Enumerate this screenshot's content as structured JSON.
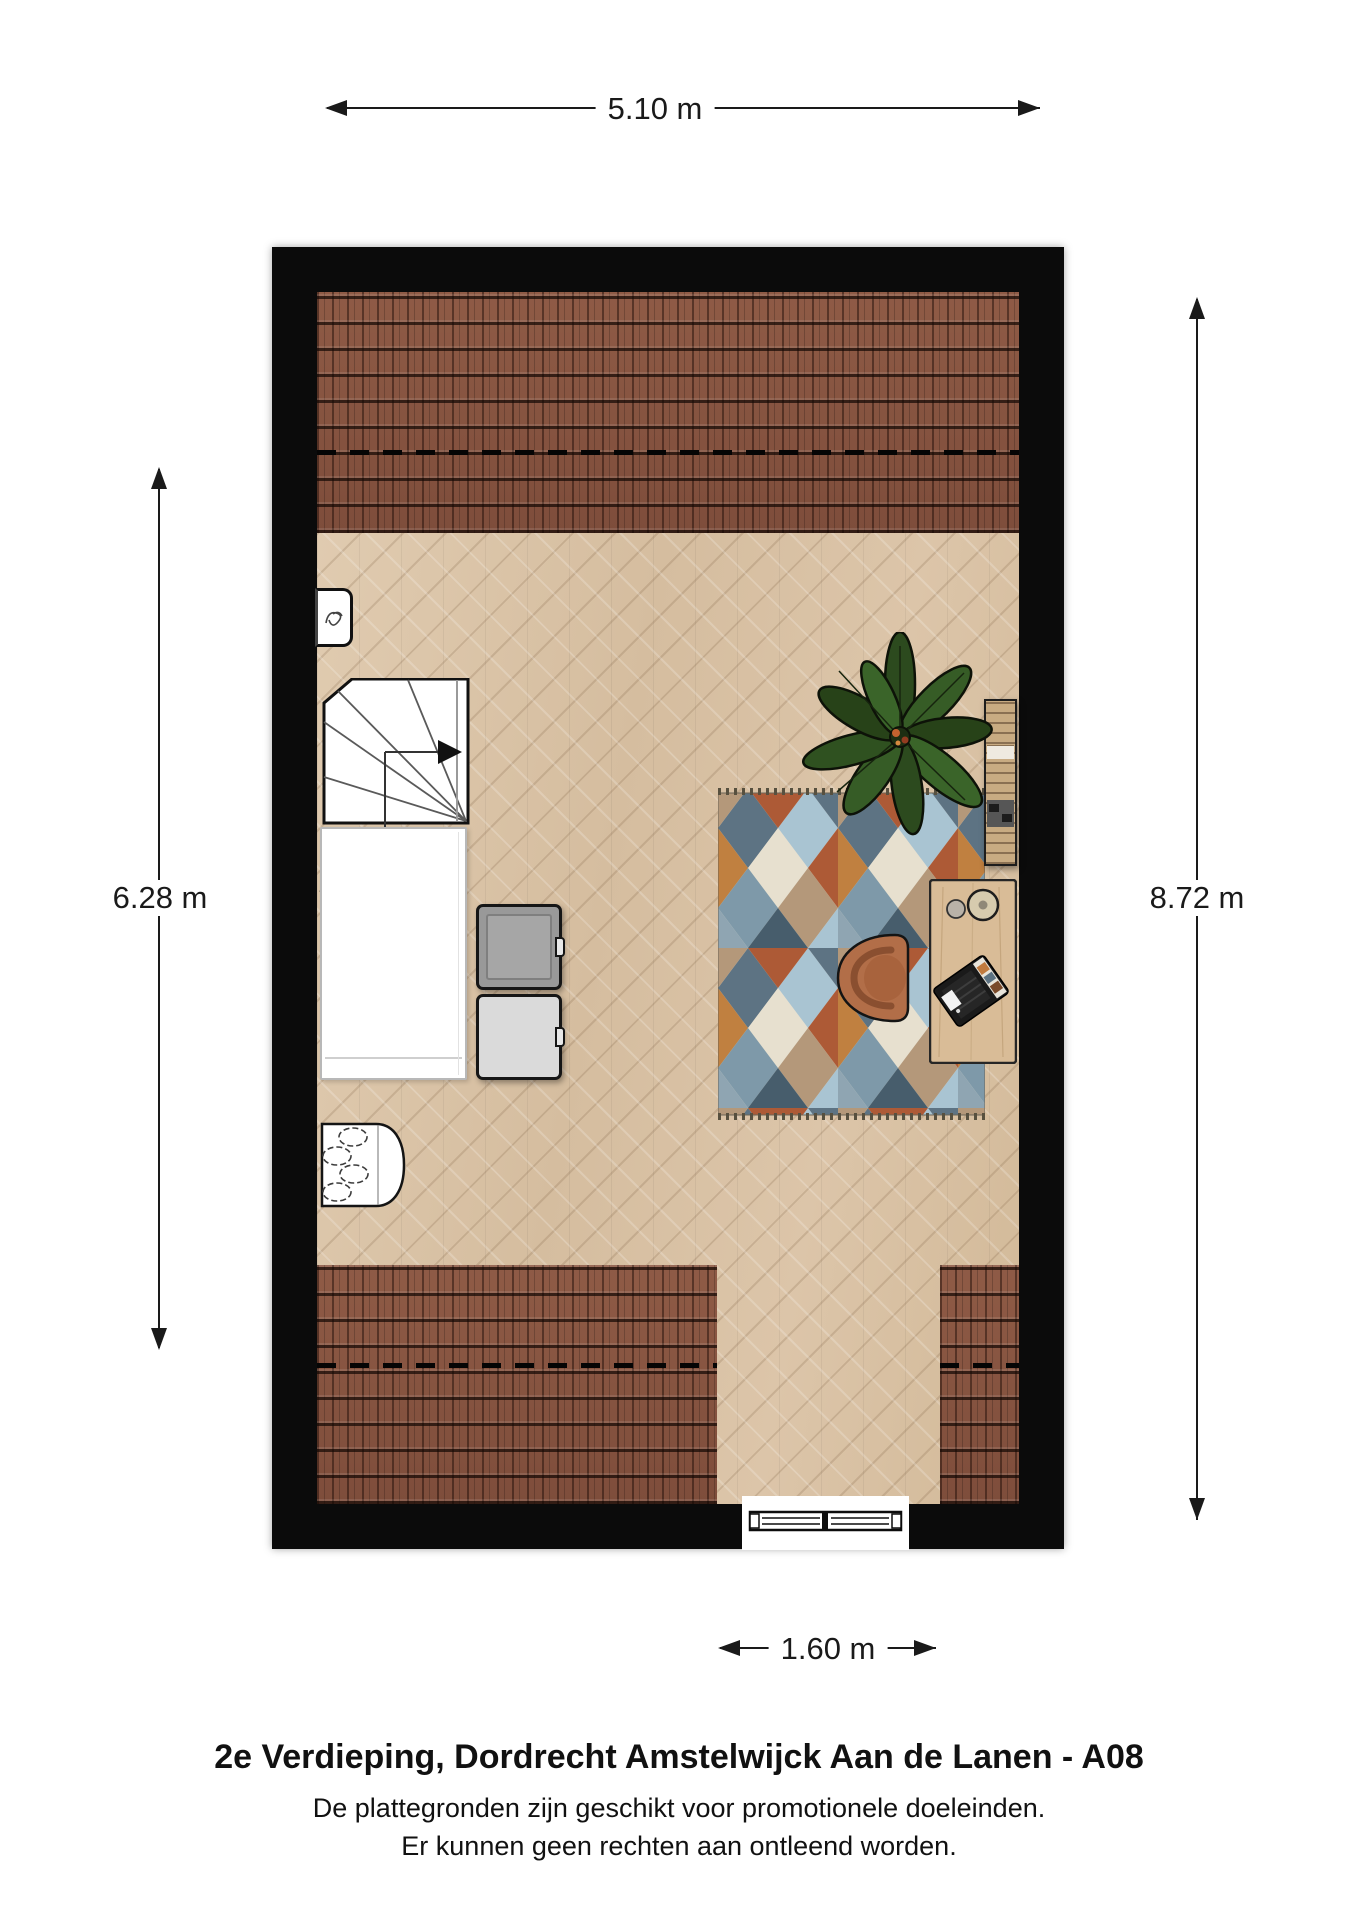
{
  "dimensions": {
    "top": "5.10 m",
    "left": "6.28 m",
    "right": "8.72 m",
    "bottom": "1.60 m"
  },
  "footer": {
    "title": "2e Verdieping, Dordrecht Amstelwijck Aan de Lanen - A08",
    "disclaimer1": "De plattegronden zijn geschikt voor promotionele doeleinden.",
    "disclaimer2": "Er kunnen geen rechten aan ontleend worden."
  },
  "colors": {
    "wall": "#0b0b0b",
    "roof_tile": "#8a5743",
    "floor_wood": "#d9c3a7",
    "rug_cream": "#e7e0cf",
    "rug_slate": "#5d7383",
    "rug_lightblue": "#a9c4d2",
    "rug_steelblue": "#7e99a9",
    "rug_rust": "#ad5a36",
    "rug_orange": "#c08040",
    "rug_tan": "#b4987a",
    "chair": "#b26e48",
    "desk_wood": "#d9bc97",
    "plant_green": "#2f5120"
  },
  "elements": [
    "sloped-roof-area-top",
    "sloped-roof-area-bottom",
    "headroom-dashed-line",
    "staircase",
    "stair-direction-arrow",
    "bed",
    "cabinet-dark",
    "cabinet-light",
    "wall-fixture",
    "washbasin",
    "plant",
    "rug",
    "bookshelf",
    "desk",
    "desk-chair",
    "laptop",
    "desk-lamp",
    "window"
  ]
}
